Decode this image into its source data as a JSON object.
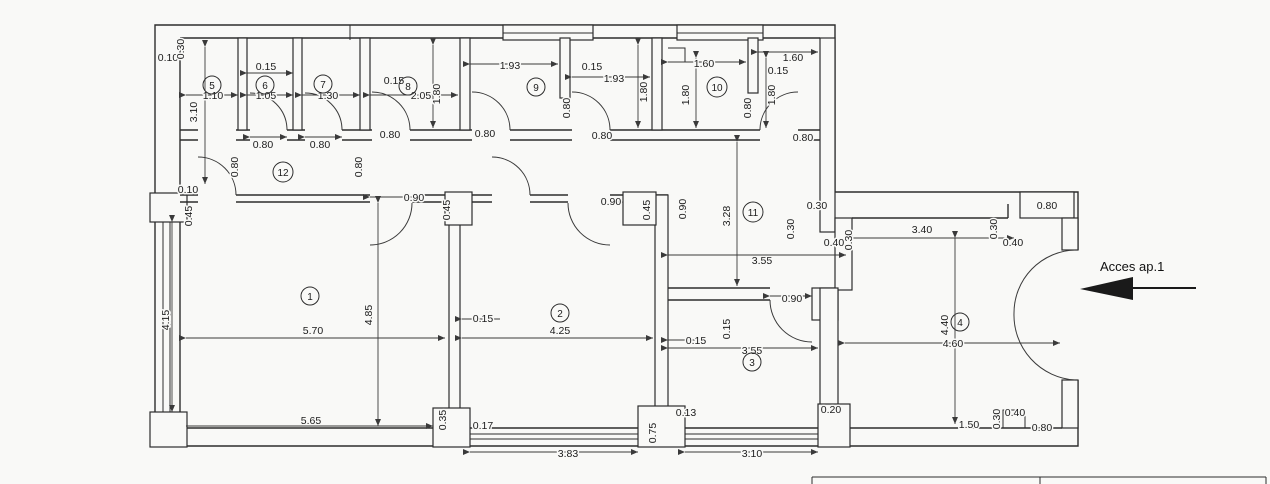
{
  "drawing": {
    "access_label": "Acces ap.1",
    "rooms": {
      "r1": "1",
      "r2": "2",
      "r3": "3",
      "r4": "4",
      "r5": "5",
      "r6": "6",
      "r7": "7",
      "r8": "8",
      "r9": "9",
      "r10": "10",
      "r11": "11",
      "r12": "12"
    },
    "dims": {
      "tl_gap": "0.10",
      "tl_wall": "0.30",
      "r5_depth": "3.10",
      "r5_w": "1.10",
      "r6_gap": "0.15",
      "r6_w": "1.05",
      "r7_w": "1.30",
      "r8_gap": "0.15",
      "r8_w": "2.05",
      "r8_h": "1.80",
      "d6_door": "0.80",
      "d7_door": "0.80",
      "d8_door": "0.80",
      "d9a_door": "0.80",
      "d9b_door": "0.80",
      "d10_door": "0.80",
      "c12_door1": "0.80",
      "c12_door2": "0.80",
      "left_gap": "0.10",
      "left_pillar": "0.45",
      "r9_w1": "1.93",
      "r9_gap": "0.15",
      "r9_w2": "1.93",
      "r9_h": "1.80",
      "r9_door": "0.80",
      "r10_w1": "1.60",
      "r10_h1": "1.80",
      "r10_gap": "0.15",
      "r10_w2": "1.60",
      "r10_door": "0.80",
      "r10_h2": "1.80",
      "r1_door": "0.90",
      "r1_pillar": "0.45",
      "r2_door": "0.90",
      "r2_pillar": "0.45",
      "r2_door_v": "0.90",
      "c11_h": "3.28",
      "c11_w": "3.55",
      "c11_wall1": "0.30",
      "c11_wall2": "0.30",
      "c11_niche": "0.40",
      "c11_wall3": "0.30",
      "r4_top": "3.40",
      "r4_niche_h": "0.30",
      "r4_niche_w": "0.40",
      "r4_door_niche": "0.80",
      "left_h": "4.15",
      "r1_h": "4.85",
      "r1_w": "5.70",
      "wall12": "0.15",
      "r1_wb": "5.65",
      "r1_pb": "0.35",
      "r1_pb2": "0.17",
      "r2_w": "4.25",
      "r2_wb": "3.83",
      "r2_pb": "0.75",
      "r2_pb2": "0.13",
      "r3_door": "0.90",
      "r3_wall_v": "0.15",
      "r3_gap": "0.15",
      "r3_w": "3.55",
      "r3_wb": "3.10",
      "r3_pb": "0.20",
      "r4_h": "4.40",
      "r4_w": "4.60",
      "r4_b1": "1.50",
      "r4_b2": "0.30",
      "r4_b3": "0.40",
      "r4_b4": "0.80"
    }
  }
}
